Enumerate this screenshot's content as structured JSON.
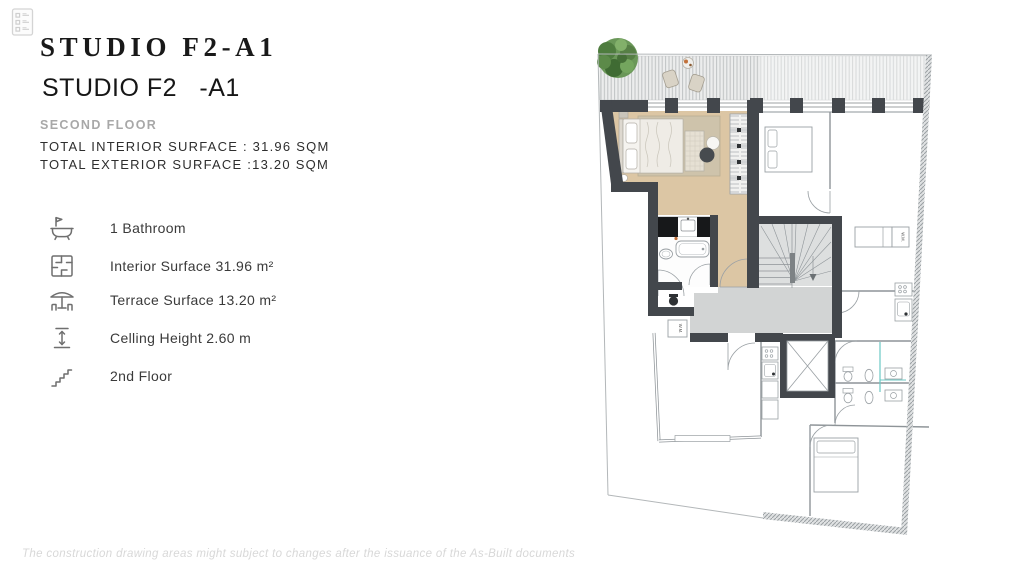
{
  "header": {
    "title": "STUDIO F2-A1",
    "subtitle": "STUDIO F2   -A1",
    "floor_label": "SECOND FLOOR",
    "total_interior": "TOTAL INTERIOR SURFACE : 31.96 SQM",
    "total_exterior": "TOTAL EXTERIOR SURFACE :13.20 SQM"
  },
  "features": [
    {
      "icon": "bathtub-icon",
      "label": "1 Bathroom"
    },
    {
      "icon": "floorplan-icon",
      "label": "Interior Surface 31.96 m²"
    },
    {
      "icon": "terrace-icon",
      "label": "Terrace Surface 13.20 m²"
    },
    {
      "icon": "ceiling-height-icon",
      "label": "Celling Height 2.60 m"
    },
    {
      "icon": "stairs-icon",
      "label": "2nd Floor"
    }
  ],
  "floor_plan": {
    "labels": {
      "washing_machine": "W.M."
    },
    "colors": {
      "wall": "#43474c",
      "floor_tan": "#dcc6a4",
      "rug_beige": "#cec3ab",
      "hall_gray": "#d2d4d4",
      "stairs_gray": "#dddfdf",
      "tree_green": "#6a9758",
      "plumbing_teal": "#6cc8c4"
    }
  },
  "footer": {
    "disclaimer": "The construction drawing areas might subject to changes after the issuance of the As-Built documents"
  }
}
